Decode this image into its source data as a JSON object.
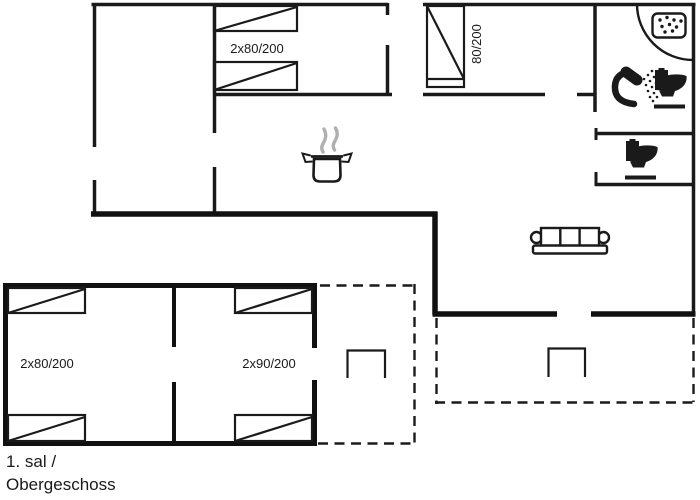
{
  "floor_label": {
    "line1": "1. sal /",
    "line2": "Obergeschoss"
  },
  "bed_labels": {
    "top_left_room": "2x80/200",
    "top_middle_room": "80/200",
    "bottom_room_left": "2x80/200",
    "bottom_room_right": "2x90/200"
  },
  "icons": {
    "corner_shower": "corner shower with drain tray",
    "shower_head": "hand shower spraying",
    "toilet_bathroom": "toilet",
    "toilet_wc": "toilet",
    "cooking_pot": "pot with steam (kitchen)",
    "sofa": "three-seat sofa",
    "terrace_tables": "table symbols on dashed terraces"
  },
  "colors": {
    "line": "#1a1a1a",
    "thick_wall": "#111111",
    "steam": "#b0b0b0",
    "background": "#ffffff"
  }
}
